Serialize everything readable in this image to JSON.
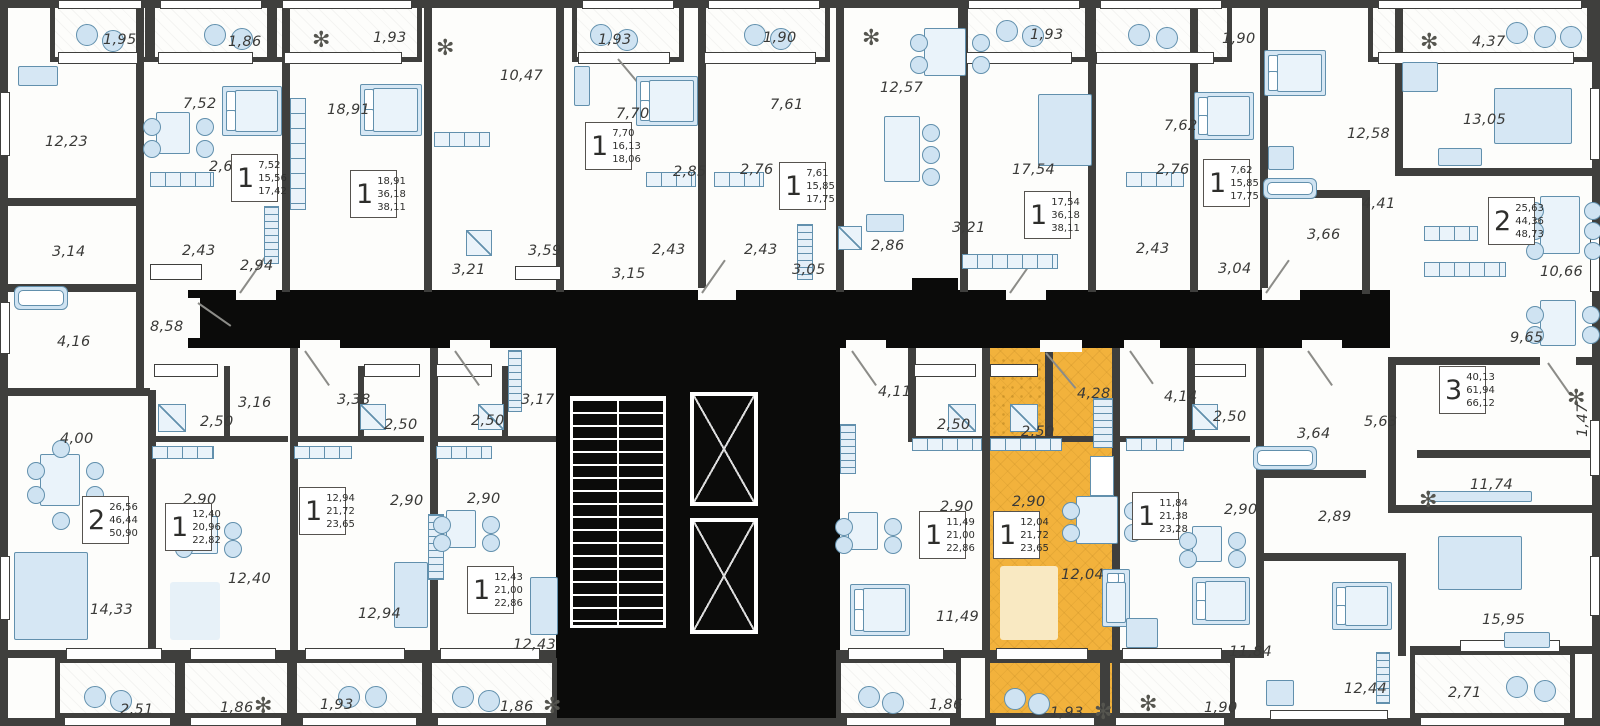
{
  "floor_plan": {
    "description": "Residential building floor plan with apartment room areas, one highlighted apartment",
    "colors": {
      "wall": "#3F3F3D",
      "core_black": "#0B0B0A",
      "highlight_yellow": "#F2B23C",
      "furniture_fill": "#D6E7F4",
      "furniture_stroke": "#6290AD",
      "label_text": "#3A3A38"
    },
    "selected_apartment": {
      "rooms": "1",
      "area_values": [
        "12,04",
        "21,72",
        "23,65"
      ],
      "balcony_label": "1,93",
      "highlighted": true
    },
    "room_labels": [
      {
        "text": "1,95",
        "x": 103,
        "y": 32
      },
      {
        "text": "1,86",
        "x": 228,
        "y": 34
      },
      {
        "text": "1,93",
        "x": 373,
        "y": 30
      },
      {
        "text": "1,93",
        "x": 598,
        "y": 32
      },
      {
        "text": "1,90",
        "x": 763,
        "y": 30
      },
      {
        "text": "1,93",
        "x": 1030,
        "y": 27
      },
      {
        "text": "1,90",
        "x": 1222,
        "y": 31
      },
      {
        "text": "4,37",
        "x": 1472,
        "y": 34
      },
      {
        "text": "12,23",
        "x": 45,
        "y": 134
      },
      {
        "text": "7,52",
        "x": 183,
        "y": 96
      },
      {
        "text": "2,67",
        "x": 209,
        "y": 159
      },
      {
        "text": "18,91",
        "x": 327,
        "y": 102
      },
      {
        "text": "10,47",
        "x": 500,
        "y": 68
      },
      {
        "text": "7,70",
        "x": 616,
        "y": 106
      },
      {
        "text": "2,85",
        "x": 673,
        "y": 164
      },
      {
        "text": "2,76",
        "x": 740,
        "y": 162
      },
      {
        "text": "7,61",
        "x": 770,
        "y": 97
      },
      {
        "text": "12,57",
        "x": 880,
        "y": 80
      },
      {
        "text": "17,54",
        "x": 1012,
        "y": 162
      },
      {
        "text": "7,62",
        "x": 1164,
        "y": 118
      },
      {
        "text": "2,76",
        "x": 1156,
        "y": 162
      },
      {
        "text": "12,58",
        "x": 1347,
        "y": 126
      },
      {
        "text": "13,05",
        "x": 1463,
        "y": 112
      },
      {
        "text": "3,14",
        "x": 52,
        "y": 244
      },
      {
        "text": "2,43",
        "x": 182,
        "y": 243
      },
      {
        "text": "2,94",
        "x": 240,
        "y": 258
      },
      {
        "text": "3,21",
        "x": 452,
        "y": 262
      },
      {
        "text": "3,59",
        "x": 528,
        "y": 243
      },
      {
        "text": "3,15",
        "x": 612,
        "y": 266
      },
      {
        "text": "2,43",
        "x": 652,
        "y": 242
      },
      {
        "text": "2,43",
        "x": 744,
        "y": 242
      },
      {
        "text": "3,05",
        "x": 792,
        "y": 262
      },
      {
        "text": "2,86",
        "x": 871,
        "y": 238
      },
      {
        "text": "3,21",
        "x": 952,
        "y": 220
      },
      {
        "text": "2,43",
        "x": 1136,
        "y": 241
      },
      {
        "text": "3,04",
        "x": 1218,
        "y": 261
      },
      {
        "text": "3,66",
        "x": 1307,
        "y": 227
      },
      {
        "text": "4,41",
        "x": 1362,
        "y": 196
      },
      {
        "text": "10,66",
        "x": 1540,
        "y": 264
      },
      {
        "text": "4,16",
        "x": 57,
        "y": 334
      },
      {
        "text": "8,58",
        "x": 150,
        "y": 319
      },
      {
        "text": "9,65",
        "x": 1510,
        "y": 330
      },
      {
        "text": "3,16",
        "x": 238,
        "y": 395
      },
      {
        "text": "3,38",
        "x": 337,
        "y": 392
      },
      {
        "text": "3,17",
        "x": 521,
        "y": 392
      },
      {
        "text": "4,11",
        "x": 878,
        "y": 384
      },
      {
        "text": "4,28",
        "x": 1077,
        "y": 386
      },
      {
        "text": "4,14",
        "x": 1164,
        "y": 389
      },
      {
        "text": "5,63",
        "x": 1364,
        "y": 414
      },
      {
        "text": "3,64",
        "x": 1297,
        "y": 426
      },
      {
        "text": "2,50",
        "x": 200,
        "y": 414
      },
      {
        "text": "2,50",
        "x": 384,
        "y": 417
      },
      {
        "text": "2,50",
        "x": 471,
        "y": 413
      },
      {
        "text": "2,50",
        "x": 937,
        "y": 417
      },
      {
        "text": "2,50",
        "x": 1021,
        "y": 424
      },
      {
        "text": "2,50",
        "x": 1213,
        "y": 409
      },
      {
        "text": "4,00",
        "x": 60,
        "y": 431
      },
      {
        "text": "2,90",
        "x": 183,
        "y": 492
      },
      {
        "text": "2,90",
        "x": 390,
        "y": 493
      },
      {
        "text": "2,90",
        "x": 467,
        "y": 491
      },
      {
        "text": "2,90",
        "x": 940,
        "y": 499
      },
      {
        "text": "2,90",
        "x": 1012,
        "y": 494
      },
      {
        "text": "2,90",
        "x": 1224,
        "y": 502
      },
      {
        "text": "2,89",
        "x": 1318,
        "y": 509
      },
      {
        "text": "1,47",
        "x": 1575,
        "y": 437,
        "rot": -90
      },
      {
        "text": "11,74",
        "x": 1470,
        "y": 477
      },
      {
        "text": "14,33",
        "x": 90,
        "y": 602
      },
      {
        "text": "12,40",
        "x": 228,
        "y": 571
      },
      {
        "text": "12,94",
        "x": 358,
        "y": 606
      },
      {
        "text": "12,43",
        "x": 513,
        "y": 637
      },
      {
        "text": "11,49",
        "x": 936,
        "y": 609
      },
      {
        "text": "12,04",
        "x": 1061,
        "y": 567
      },
      {
        "text": "11,84",
        "x": 1229,
        "y": 644
      },
      {
        "text": "15,95",
        "x": 1482,
        "y": 612
      },
      {
        "text": "12,44",
        "x": 1344,
        "y": 681
      },
      {
        "text": "2,51",
        "x": 120,
        "y": 702
      },
      {
        "text": "1,86",
        "x": 220,
        "y": 700
      },
      {
        "text": "1,93",
        "x": 320,
        "y": 697
      },
      {
        "text": "1,86",
        "x": 500,
        "y": 699
      },
      {
        "text": "1,86",
        "x": 929,
        "y": 697
      },
      {
        "text": "1,93",
        "x": 1050,
        "y": 705
      },
      {
        "text": "1,90",
        "x": 1204,
        "y": 700
      },
      {
        "text": "2,71",
        "x": 1448,
        "y": 685
      }
    ],
    "apartment_badges": [
      {
        "rooms": "1",
        "area_values": [
          "7,52",
          "15,56",
          "17,42"
        ],
        "x": 231,
        "y": 154
      },
      {
        "rooms": "1",
        "area_values": [
          "18,91",
          "36,18",
          "38,11"
        ],
        "x": 350,
        "y": 170
      },
      {
        "rooms": "1",
        "area_values": [
          "7,70",
          "16,13",
          "18,06"
        ],
        "x": 585,
        "y": 122
      },
      {
        "rooms": "1",
        "area_values": [
          "7,61",
          "15,85",
          "17,75"
        ],
        "x": 779,
        "y": 162
      },
      {
        "rooms": "1",
        "area_values": [
          "17,54",
          "36,18",
          "38,11"
        ],
        "x": 1024,
        "y": 191
      },
      {
        "rooms": "1",
        "area_values": [
          "7,62",
          "15,85",
          "17,75"
        ],
        "x": 1203,
        "y": 159
      },
      {
        "rooms": "2",
        "area_values": [
          "25,63",
          "44,36",
          "48,73"
        ],
        "x": 1488,
        "y": 197
      },
      {
        "rooms": "2",
        "area_values": [
          "26,56",
          "46,44",
          "50,90"
        ],
        "x": 82,
        "y": 496
      },
      {
        "rooms": "1",
        "area_values": [
          "12,40",
          "20,96",
          "22,82"
        ],
        "x": 165,
        "y": 503
      },
      {
        "rooms": "1",
        "area_values": [
          "12,94",
          "21,72",
          "23,65"
        ],
        "x": 299,
        "y": 487
      },
      {
        "rooms": "1",
        "area_values": [
          "12,43",
          "21,00",
          "22,86"
        ],
        "x": 467,
        "y": 566
      },
      {
        "rooms": "1",
        "area_values": [
          "11,49",
          "21,00",
          "22,86"
        ],
        "x": 919,
        "y": 511
      },
      {
        "rooms": "1",
        "area_values": [
          "12,04",
          "21,72",
          "23,65"
        ],
        "x": 993,
        "y": 511,
        "selected": true
      },
      {
        "rooms": "1",
        "area_values": [
          "11,84",
          "21,38",
          "23,28"
        ],
        "x": 1132,
        "y": 492
      },
      {
        "rooms": "3",
        "area_values": [
          "40,13",
          "61,94",
          "66,12"
        ],
        "x": 1439,
        "y": 366
      }
    ]
  }
}
